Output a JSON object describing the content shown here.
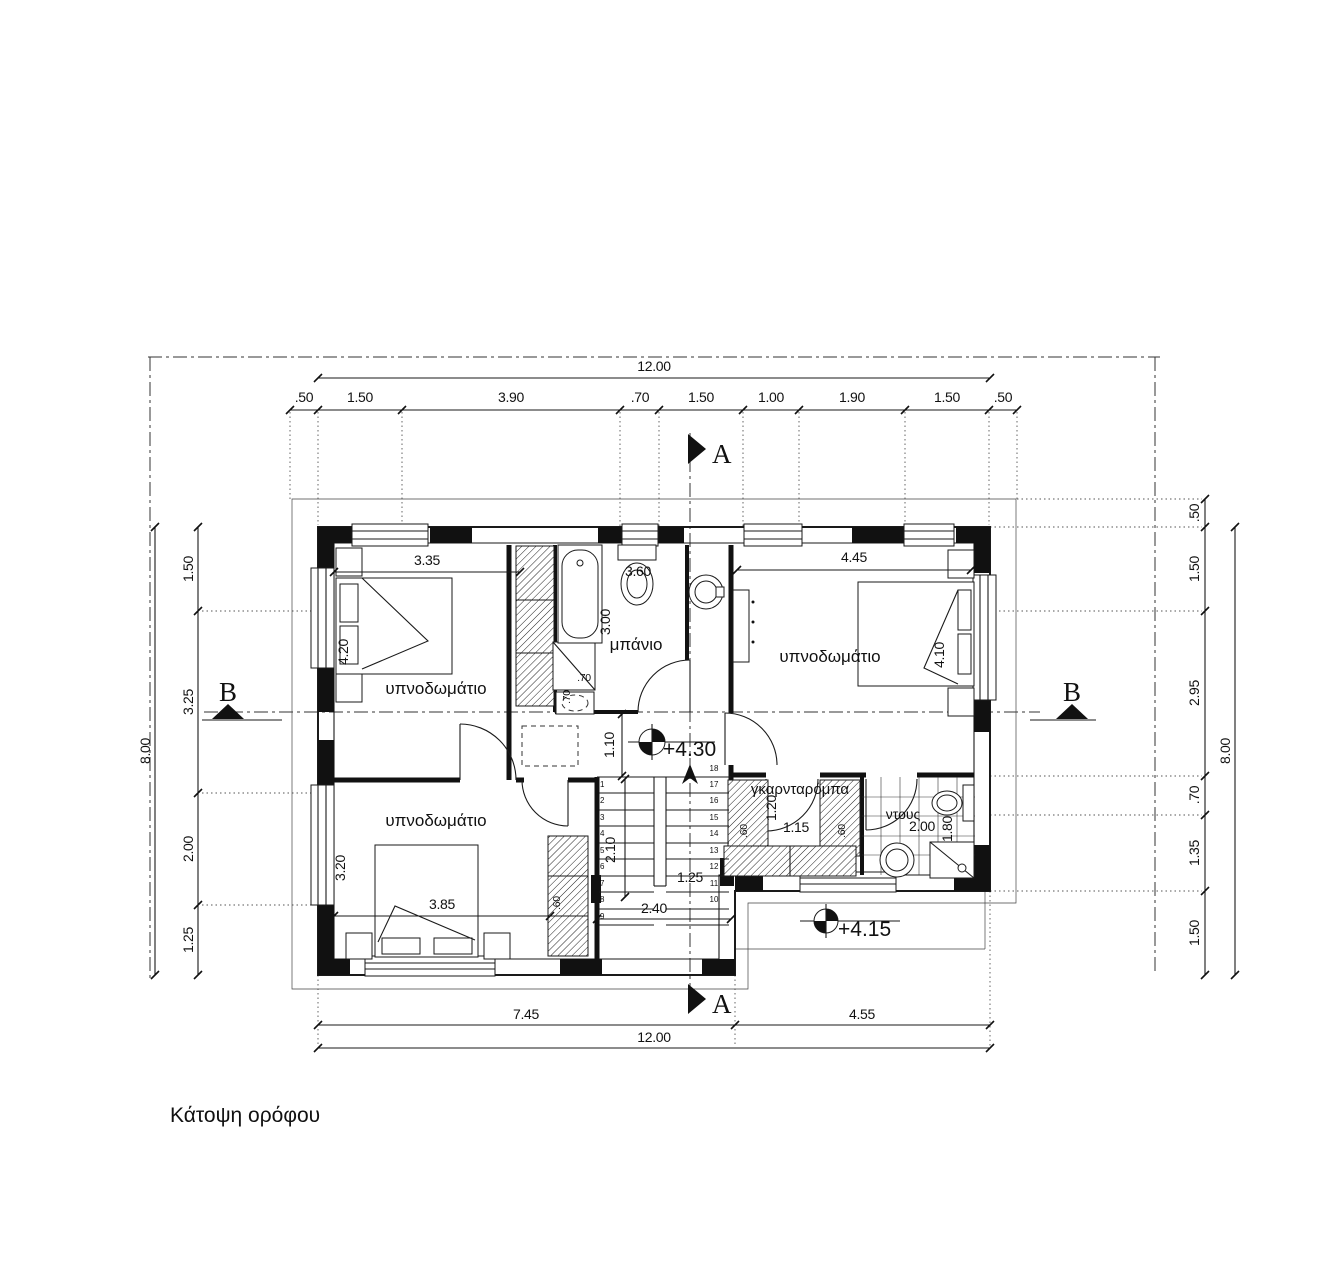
{
  "title": "Κάτοψη ορόφου",
  "sections": {
    "a_top": "A",
    "a_bottom": "A",
    "b_left": "B",
    "b_right": "B"
  },
  "levels": {
    "hall": "+4.30",
    "stair": "+4.15"
  },
  "rooms": {
    "bedroom_top_left": "υπνοδωμάτιο",
    "bedroom_top_right": "υπνοδωμάτιο",
    "bedroom_bottom_left": "υπνοδωμάτιο",
    "bathroom": "μπάνιο",
    "wardrobe": "γκαρνταρόμπα",
    "shower": "ντους"
  },
  "dims": {
    "top": {
      "total": "12.00",
      "chain": [
        ".50",
        "1.50",
        "3.90",
        ".70",
        "1.50",
        "1.00",
        "1.90",
        "1.50",
        ".50"
      ]
    },
    "bottom": {
      "total": "12.00",
      "chain": [
        "7.45",
        "4.55"
      ]
    },
    "left": {
      "total": "8.00",
      "chain": [
        "1.50",
        "3.25",
        "2.00",
        "1.25"
      ]
    },
    "right": {
      "total": "8.00",
      "chain": [
        ".50",
        "1.50",
        "2.95",
        ".70",
        "1.35",
        "1.50"
      ]
    },
    "interior": {
      "bed1_w": "3.35",
      "bed1_d": "4.20",
      "bed2_w": "4.45",
      "bed2_d": "4.10",
      "bath_d": "3.00",
      "bath_fix": "3.60",
      "duct_w": ".70",
      "duct_d": ".70",
      "hall": "1.10",
      "stair_run": "2.10",
      "stair_flight": "1.25",
      "stair_w": "2.40",
      "bed3_w": "3.85",
      "bed3_d": "3.20",
      "closet3": ".60",
      "ward_d": "1.20",
      "ward_w": "1.15",
      "ward_c1": ".60",
      "ward_c2": ".60",
      "shower_w": "2.00",
      "shower_d": "1.80"
    }
  },
  "stairs": {
    "left": [
      "1",
      "2",
      "3",
      "4",
      "5",
      "6",
      "7",
      "8",
      "9"
    ],
    "right": [
      "18",
      "17",
      "16",
      "15",
      "14",
      "13",
      "12",
      "11",
      "10"
    ]
  }
}
